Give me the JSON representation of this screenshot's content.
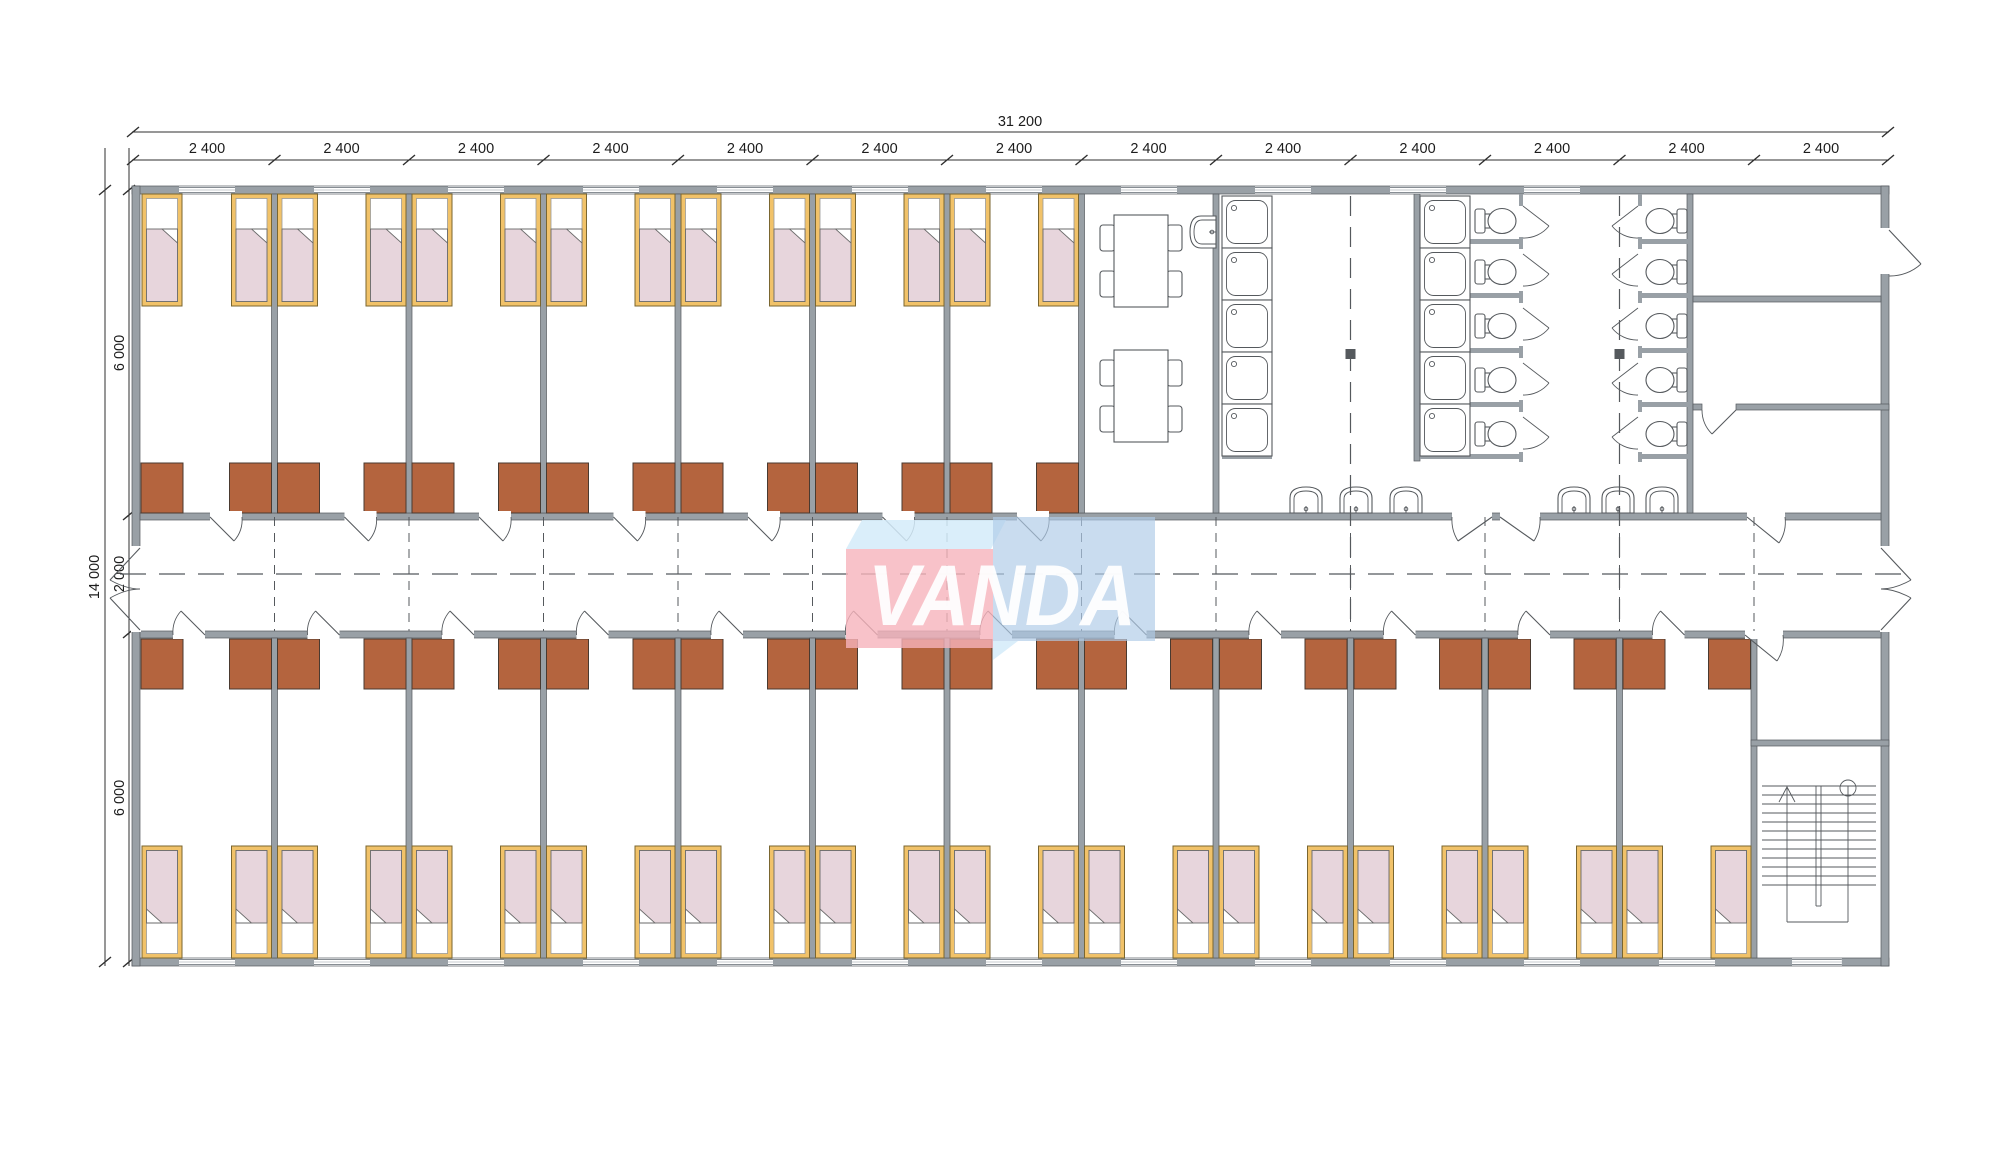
{
  "logo": {
    "text": "VANDA"
  },
  "dimensions": {
    "total_width": "31 200",
    "top_segments": [
      "2 400",
      "2 400",
      "2 400",
      "2 400",
      "2 400",
      "2 400",
      "2 400",
      "2 400",
      "2 400",
      "2 400",
      "2 400",
      "2 400",
      "2 400"
    ],
    "total_height": "14 000",
    "left_segments": [
      "6 000",
      "2 000",
      "6 000"
    ]
  },
  "elements": {
    "module_count": 13,
    "bedrooms_top_row": 7,
    "bedrooms_bottom_row": 12,
    "beds": 38,
    "wardrobes": 38,
    "dining_tables": 2,
    "shower_trays": 10,
    "toilets": 10,
    "wash_basins": 7,
    "staircases": 1
  },
  "colors": {
    "wall": "#99A0A6",
    "wallStroke": "#54595E",
    "line": "#55595d",
    "dim": "#2f2f2f",
    "bedFrame": "#F1C269",
    "bedBlanket": "#E7D5DC",
    "wardrobe": "#B4643E",
    "logoPink": "#F6B3BC",
    "logoBlue": "#AFCCE7",
    "logoLight": "#D4EBF9",
    "logoText": "#FFFFFF"
  }
}
